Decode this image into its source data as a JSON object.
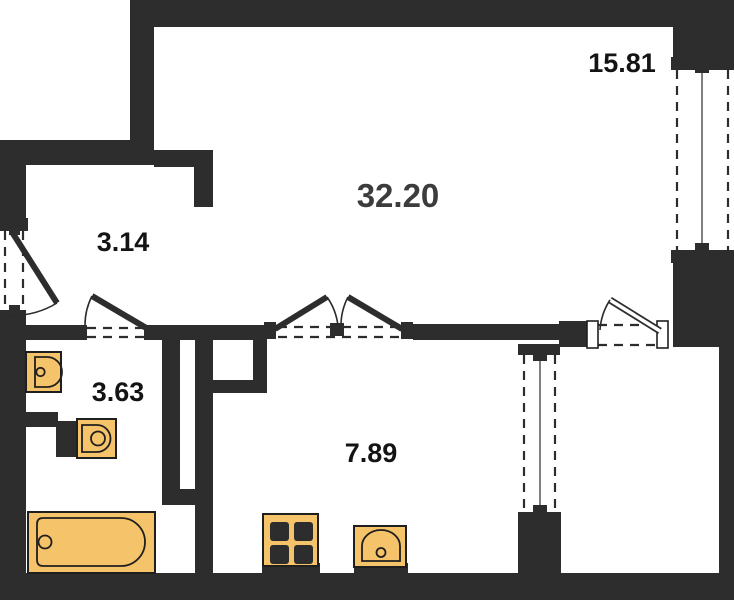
{
  "colors": {
    "bg": "#ffffff",
    "wall": "#2d2d2d",
    "fixture": "#f5c36a",
    "outline": "#1f1f1f",
    "label": "#141414",
    "label-big": "#3c3c3c"
  },
  "rooms": {
    "living": {
      "area": "32.20"
    },
    "room_right": {
      "area": "15.81"
    },
    "hallway": {
      "area": "3.14"
    },
    "bathroom": {
      "area": "3.63"
    },
    "kitchen": {
      "area": "7.89"
    }
  },
  "fixtures": [
    "bathroom-sink",
    "toilet",
    "bathtub",
    "stove",
    "kitchen-sink"
  ],
  "doors": [
    "entrance-door",
    "bathroom-door",
    "double-door",
    "balcony-door"
  ],
  "windows": [
    "right-window-bay",
    "kitchen-window-bay"
  ]
}
